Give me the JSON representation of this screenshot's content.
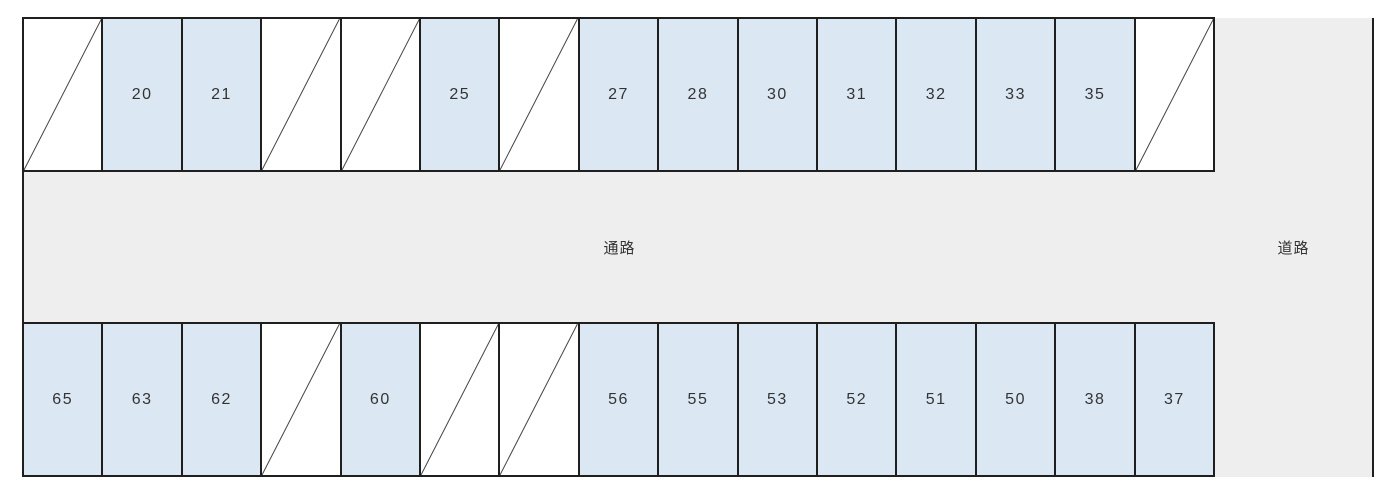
{
  "diagram": {
    "aisle_label": "通路",
    "road_label": "道路"
  },
  "colors": {
    "space_available_fill": "#dbe8f4",
    "space_unavailable_fill": "#ffffff",
    "area_fill": "#eeeeee",
    "border": "#1f1f1f",
    "diagonal_line": "#444444",
    "text": "#333333"
  },
  "rows": {
    "top": [
      {
        "label": "",
        "crossed": true
      },
      {
        "label": "20",
        "crossed": false
      },
      {
        "label": "21",
        "crossed": false
      },
      {
        "label": "",
        "crossed": true
      },
      {
        "label": "",
        "crossed": true
      },
      {
        "label": "25",
        "crossed": false
      },
      {
        "label": "",
        "crossed": true
      },
      {
        "label": "27",
        "crossed": false
      },
      {
        "label": "28",
        "crossed": false
      },
      {
        "label": "30",
        "crossed": false
      },
      {
        "label": "31",
        "crossed": false
      },
      {
        "label": "32",
        "crossed": false
      },
      {
        "label": "33",
        "crossed": false
      },
      {
        "label": "35",
        "crossed": false
      },
      {
        "label": "",
        "crossed": true
      }
    ],
    "bottom": [
      {
        "label": "65",
        "crossed": false
      },
      {
        "label": "63",
        "crossed": false
      },
      {
        "label": "62",
        "crossed": false
      },
      {
        "label": "",
        "crossed": true
      },
      {
        "label": "60",
        "crossed": false
      },
      {
        "label": "",
        "crossed": true
      },
      {
        "label": "",
        "crossed": true
      },
      {
        "label": "56",
        "crossed": false
      },
      {
        "label": "55",
        "crossed": false
      },
      {
        "label": "53",
        "crossed": false
      },
      {
        "label": "52",
        "crossed": false
      },
      {
        "label": "51",
        "crossed": false
      },
      {
        "label": "50",
        "crossed": false
      },
      {
        "label": "38",
        "crossed": false
      },
      {
        "label": "37",
        "crossed": false
      }
    ]
  }
}
